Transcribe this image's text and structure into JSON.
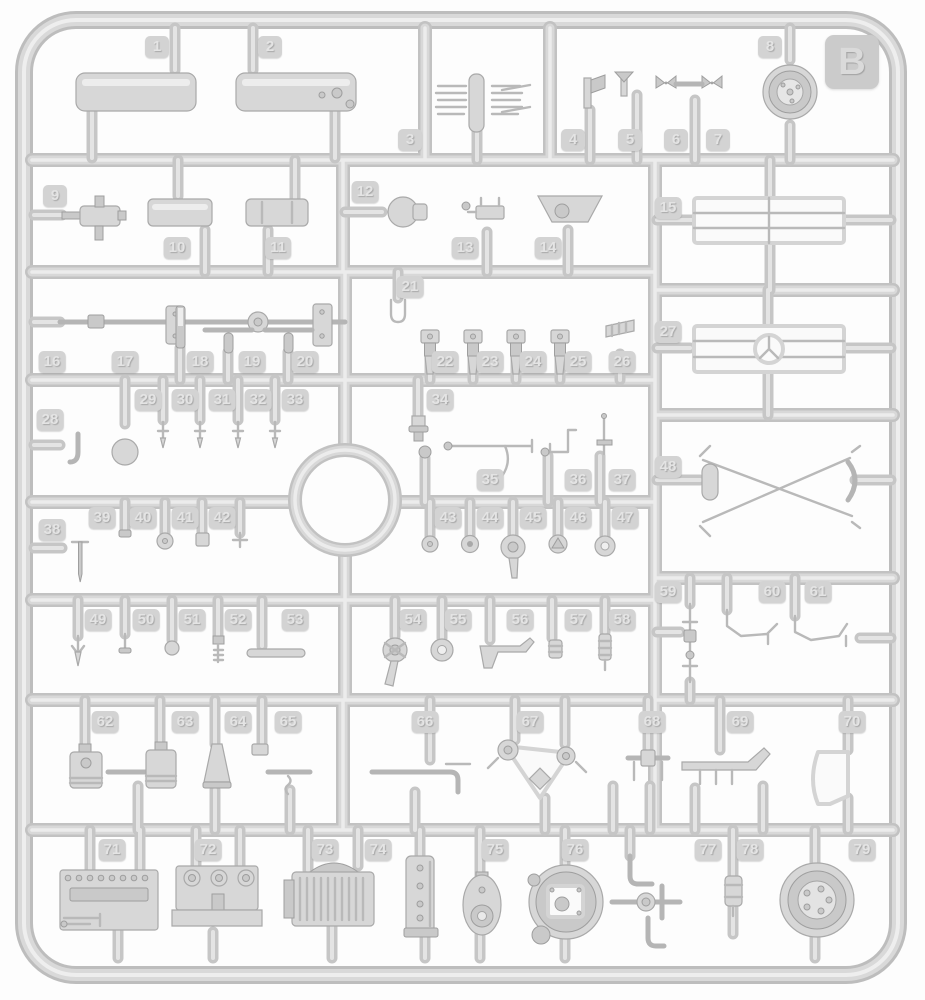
{
  "sprue": {
    "letter": "B",
    "palette": {
      "plastic": "#d7d7d7",
      "runner": "#c2c2c2",
      "tag_bg": "#d3d3d3",
      "tag_text": "#e4e4e4",
      "background": "#fdfdfd"
    },
    "parts": [
      {
        "label": "1",
        "x": 157,
        "y": 47
      },
      {
        "label": "2",
        "x": 270,
        "y": 47
      },
      {
        "label": "3",
        "x": 410,
        "y": 140
      },
      {
        "label": "4",
        "x": 573,
        "y": 140
      },
      {
        "label": "5",
        "x": 630,
        "y": 140
      },
      {
        "label": "6",
        "x": 676,
        "y": 140
      },
      {
        "label": "7",
        "x": 718,
        "y": 140
      },
      {
        "label": "8",
        "x": 770,
        "y": 47
      },
      {
        "label": "9",
        "x": 55,
        "y": 196
      },
      {
        "label": "10",
        "x": 177,
        "y": 248
      },
      {
        "label": "11",
        "x": 278,
        "y": 248
      },
      {
        "label": "12",
        "x": 365,
        "y": 192
      },
      {
        "label": "13",
        "x": 465,
        "y": 248
      },
      {
        "label": "14",
        "x": 548,
        "y": 248
      },
      {
        "label": "15",
        "x": 668,
        "y": 208
      },
      {
        "label": "16",
        "x": 52,
        "y": 362
      },
      {
        "label": "17",
        "x": 125,
        "y": 362
      },
      {
        "label": "18",
        "x": 200,
        "y": 362
      },
      {
        "label": "19",
        "x": 252,
        "y": 362
      },
      {
        "label": "20",
        "x": 305,
        "y": 362
      },
      {
        "label": "21",
        "x": 410,
        "y": 287
      },
      {
        "label": "22",
        "x": 445,
        "y": 362
      },
      {
        "label": "23",
        "x": 490,
        "y": 362
      },
      {
        "label": "24",
        "x": 533,
        "y": 362
      },
      {
        "label": "25",
        "x": 578,
        "y": 362
      },
      {
        "label": "26",
        "x": 622,
        "y": 362
      },
      {
        "label": "27",
        "x": 668,
        "y": 332
      },
      {
        "label": "28",
        "x": 50,
        "y": 420
      },
      {
        "label": "29",
        "x": 148,
        "y": 400
      },
      {
        "label": "30",
        "x": 185,
        "y": 400
      },
      {
        "label": "31",
        "x": 222,
        "y": 400
      },
      {
        "label": "32",
        "x": 258,
        "y": 400
      },
      {
        "label": "33",
        "x": 295,
        "y": 400
      },
      {
        "label": "34",
        "x": 440,
        "y": 400
      },
      {
        "label": "35",
        "x": 490,
        "y": 480
      },
      {
        "label": "36",
        "x": 578,
        "y": 480
      },
      {
        "label": "37",
        "x": 622,
        "y": 480
      },
      {
        "label": "38",
        "x": 52,
        "y": 530
      },
      {
        "label": "39",
        "x": 102,
        "y": 518
      },
      {
        "label": "40",
        "x": 143,
        "y": 518
      },
      {
        "label": "41",
        "x": 185,
        "y": 518
      },
      {
        "label": "42",
        "x": 222,
        "y": 518
      },
      {
        "label": "43",
        "x": 448,
        "y": 518
      },
      {
        "label": "44",
        "x": 490,
        "y": 518
      },
      {
        "label": "45",
        "x": 533,
        "y": 518
      },
      {
        "label": "46",
        "x": 578,
        "y": 518
      },
      {
        "label": "47",
        "x": 625,
        "y": 518
      },
      {
        "label": "48",
        "x": 668,
        "y": 467
      },
      {
        "label": "49",
        "x": 98,
        "y": 620
      },
      {
        "label": "50",
        "x": 146,
        "y": 620
      },
      {
        "label": "51",
        "x": 192,
        "y": 620
      },
      {
        "label": "52",
        "x": 238,
        "y": 620
      },
      {
        "label": "53",
        "x": 295,
        "y": 620
      },
      {
        "label": "54",
        "x": 413,
        "y": 620
      },
      {
        "label": "55",
        "x": 458,
        "y": 620
      },
      {
        "label": "56",
        "x": 520,
        "y": 620
      },
      {
        "label": "57",
        "x": 578,
        "y": 620
      },
      {
        "label": "58",
        "x": 622,
        "y": 620
      },
      {
        "label": "59",
        "x": 668,
        "y": 592
      },
      {
        "label": "60",
        "x": 772,
        "y": 592
      },
      {
        "label": "61",
        "x": 818,
        "y": 592
      },
      {
        "label": "62",
        "x": 105,
        "y": 722
      },
      {
        "label": "63",
        "x": 185,
        "y": 722
      },
      {
        "label": "64",
        "x": 238,
        "y": 722
      },
      {
        "label": "65",
        "x": 288,
        "y": 722
      },
      {
        "label": "66",
        "x": 425,
        "y": 722
      },
      {
        "label": "67",
        "x": 530,
        "y": 722
      },
      {
        "label": "68",
        "x": 652,
        "y": 722
      },
      {
        "label": "69",
        "x": 740,
        "y": 722
      },
      {
        "label": "70",
        "x": 852,
        "y": 722
      },
      {
        "label": "71",
        "x": 112,
        "y": 850
      },
      {
        "label": "72",
        "x": 208,
        "y": 850
      },
      {
        "label": "73",
        "x": 325,
        "y": 850
      },
      {
        "label": "74",
        "x": 378,
        "y": 850
      },
      {
        "label": "75",
        "x": 495,
        "y": 850
      },
      {
        "label": "76",
        "x": 575,
        "y": 850
      },
      {
        "label": "77",
        "x": 708,
        "y": 850
      },
      {
        "label": "78",
        "x": 750,
        "y": 850
      },
      {
        "label": "79",
        "x": 862,
        "y": 850
      }
    ]
  }
}
